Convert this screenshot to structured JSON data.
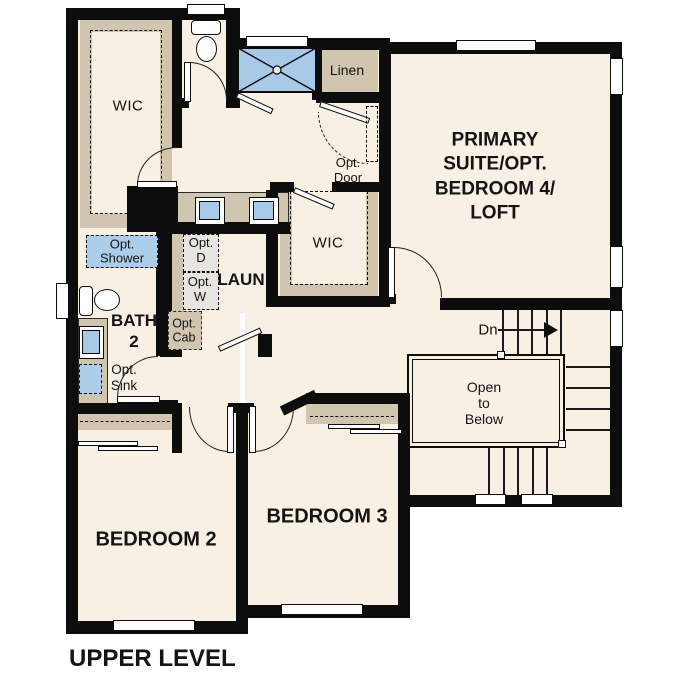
{
  "title": "UPPER LEVEL",
  "labels": {
    "wic_primary": "WIC",
    "wic_hall": "WIC",
    "linen": "Linen",
    "opt_door": "Opt.\nDoor",
    "primary_suite": "PRIMARY\nSUITE/OPT.\nBEDROOM 4/\nLOFT",
    "laundry": "LAUN",
    "opt_dryer": "Opt.\nD",
    "opt_washer": "Opt.\nW",
    "opt_cab": "Opt.\nCab",
    "opt_shower": "Opt.\nShower",
    "bath2": "BATH\n2",
    "opt_sink": "Opt.\nSink",
    "stairs_down": "Dn",
    "open_to_below": "Open\nto\nBelow",
    "bedroom2": "BEDROOM 2",
    "bedroom3": "BEDROOM 3"
  },
  "colors": {
    "wall": "#0d0d0d",
    "floor": "#f8f0e3",
    "closet_tan": "#d0c5af",
    "fixture_blue": "#a9c9e8",
    "appliance_gray": "#e6e5df",
    "background": "#ffffff",
    "text": "#141414"
  }
}
